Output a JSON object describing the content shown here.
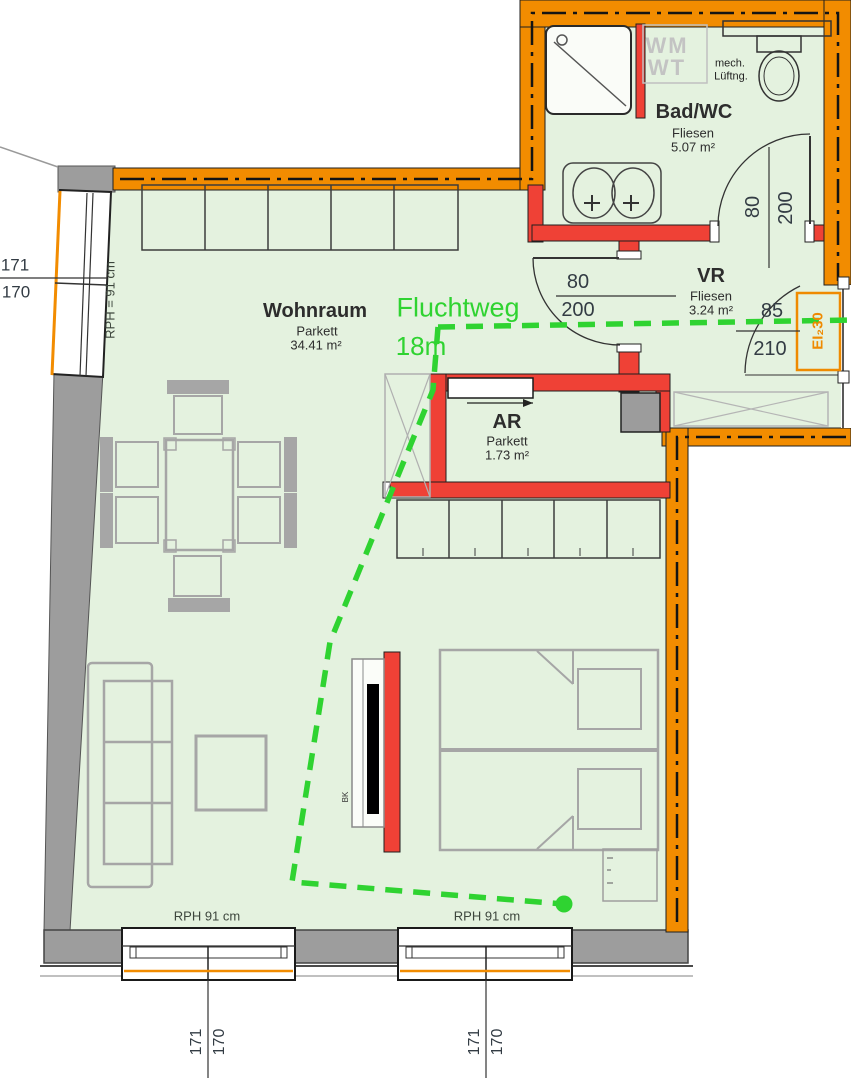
{
  "colors": {
    "wall_orange": "#F28C00",
    "wall_red": "#EF4136",
    "wall_gray": "#9D9D9D",
    "floor_green": "#E4F2DF",
    "route_green": "#2FD331"
  },
  "rooms": {
    "wohnraum": {
      "name": "Wohnraum",
      "finish": "Parkett",
      "area": "34.41 m²"
    },
    "bad_wc": {
      "name": "Bad/WC",
      "finish": "Fliesen",
      "area": "5.07 m²"
    },
    "vr": {
      "name": "VR",
      "finish": "Fliesen",
      "area": "3.24 m²"
    },
    "ar": {
      "name": "AR",
      "finish": "Parkett",
      "area": "1.73 m²"
    }
  },
  "escape_route": {
    "label": "Fluchtweg",
    "length": "18m"
  },
  "fixtures": {
    "washer": "WM",
    "dryer": "WT",
    "vent_line1": "mech.",
    "vent_line2": "Lüftng.",
    "tv_board": "BK"
  },
  "fire_door": {
    "rating": "EI₂30"
  },
  "dimensions": {
    "left_window": {
      "w": "171",
      "h": "170",
      "parapet": "RPH = 91 cm"
    },
    "vr_door": {
      "w": "80",
      "h": "200"
    },
    "bath_door": {
      "w": "80",
      "h": "200"
    },
    "entry_door": {
      "w": "85",
      "h": "210"
    },
    "south_window_1": {
      "parapet": "RPH 91 cm",
      "w": "171",
      "h": "170"
    },
    "south_window_2": {
      "parapet": "RPH 91 cm",
      "w": "171",
      "h": "170"
    }
  }
}
